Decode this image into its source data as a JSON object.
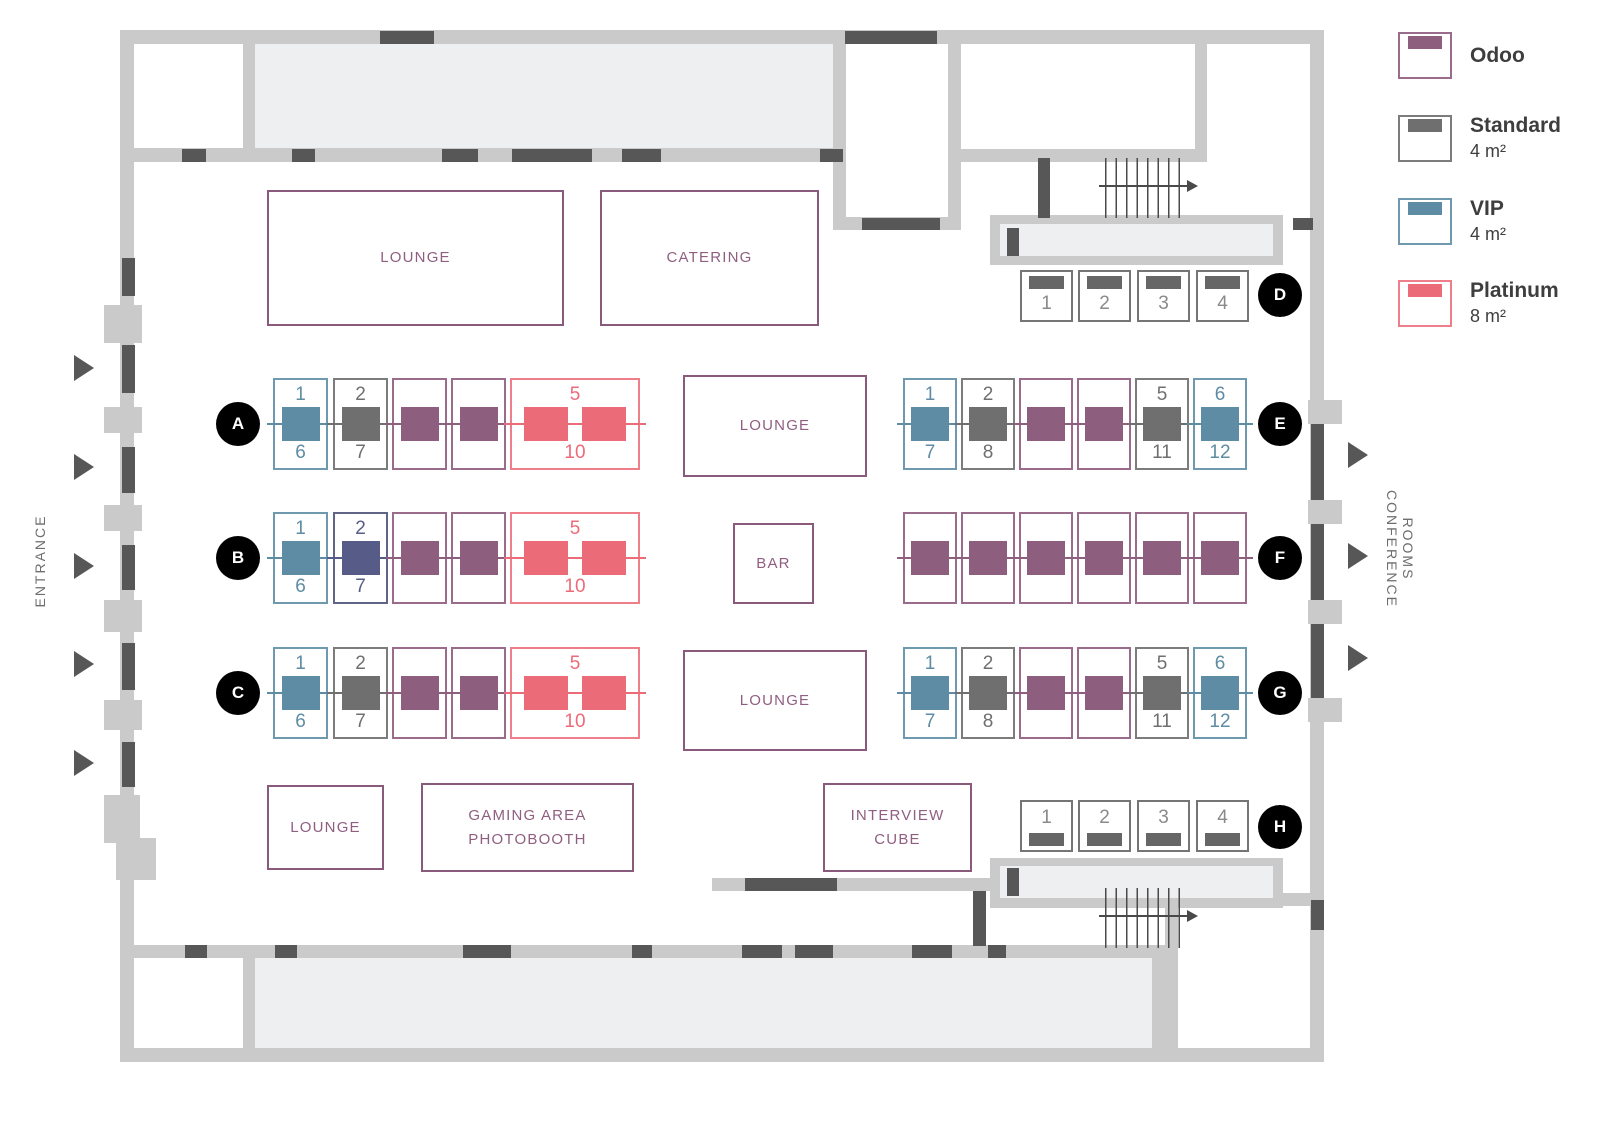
{
  "colors": {
    "odoo": "#8e5e7f",
    "odoo_border": "#9a6b8b",
    "standard": "#6f6f6f",
    "standard_border": "#7c7c7c",
    "vip": "#5e8ca4",
    "vip_border": "#6e99ae",
    "platinum": "#ec6b79",
    "platinum_border": "#ee7e8a",
    "reserved": "#575b87",
    "reserved_border": "#606489",
    "wall": "#cacaca",
    "room": "#edeff0",
    "door": "#575757",
    "label": "#8f5e81",
    "circle": "#000000"
  },
  "legend": {
    "items": [
      {
        "type": "odoo",
        "label": "Odoo",
        "size": ""
      },
      {
        "type": "standard",
        "label": "Standard",
        "size": "4 m²"
      },
      {
        "type": "vip",
        "label": "VIP",
        "size": "4 m²"
      },
      {
        "type": "platinum",
        "label": "Platinum",
        "size": "8 m²"
      }
    ]
  },
  "signs": {
    "entrance": "ENTRANCE",
    "conference_line1": "CONFERENCE",
    "conference_line2": "ROOMS"
  },
  "areas": {
    "lounge_top": "LOUNGE",
    "catering": "CATERING",
    "lounge_center_upper": "LOUNGE",
    "bar": "BAR",
    "lounge_center_lower": "LOUNGE",
    "lounge_bottom": "LOUNGE",
    "gaming_line1": "GAMING AREA",
    "gaming_line2": "PHOTOBOOTH",
    "interview_line1": "INTERVIEW",
    "interview_line2": "CUBE"
  },
  "rows": [
    {
      "letter": "A",
      "kind": "double",
      "booths": [
        {
          "type": "vip",
          "top": "1",
          "bottom": "6"
        },
        {
          "type": "standard",
          "top": "2",
          "bottom": "7"
        },
        {
          "type": "odoo"
        },
        {
          "type": "odoo"
        },
        {
          "type": "platinum",
          "top": "5",
          "bottom": "10"
        }
      ]
    },
    {
      "letter": "B",
      "kind": "double",
      "booths": [
        {
          "type": "vip",
          "top": "1",
          "bottom": "6"
        },
        {
          "type": "reserved",
          "top": "2",
          "bottom": "7"
        },
        {
          "type": "odoo"
        },
        {
          "type": "odoo"
        },
        {
          "type": "platinum",
          "top": "5",
          "bottom": "10"
        }
      ]
    },
    {
      "letter": "C",
      "kind": "double",
      "booths": [
        {
          "type": "vip",
          "top": "1",
          "bottom": "6"
        },
        {
          "type": "standard",
          "top": "2",
          "bottom": "7"
        },
        {
          "type": "odoo"
        },
        {
          "type": "odoo"
        },
        {
          "type": "platinum",
          "top": "5",
          "bottom": "10"
        }
      ]
    },
    {
      "letter": "D",
      "kind": "single-top",
      "booths": [
        {
          "type": "standard",
          "num": "1"
        },
        {
          "type": "standard",
          "num": "2"
        },
        {
          "type": "standard",
          "num": "3"
        },
        {
          "type": "standard",
          "num": "4"
        }
      ]
    },
    {
      "letter": "E",
      "kind": "double",
      "booths": [
        {
          "type": "vip",
          "top": "1",
          "bottom": "7"
        },
        {
          "type": "standard",
          "top": "2",
          "bottom": "8"
        },
        {
          "type": "odoo"
        },
        {
          "type": "odoo"
        },
        {
          "type": "standard",
          "top": "5",
          "bottom": "11"
        },
        {
          "type": "vip",
          "top": "6",
          "bottom": "12"
        }
      ]
    },
    {
      "letter": "F",
      "kind": "double",
      "booths": [
        {
          "type": "odoo"
        },
        {
          "type": "odoo"
        },
        {
          "type": "odoo"
        },
        {
          "type": "odoo"
        },
        {
          "type": "odoo"
        },
        {
          "type": "odoo"
        }
      ]
    },
    {
      "letter": "G",
      "kind": "double",
      "booths": [
        {
          "type": "vip",
          "top": "1",
          "bottom": "7"
        },
        {
          "type": "standard",
          "top": "2",
          "bottom": "8"
        },
        {
          "type": "odoo"
        },
        {
          "type": "odoo"
        },
        {
          "type": "standard",
          "top": "5",
          "bottom": "11"
        },
        {
          "type": "vip",
          "top": "6",
          "bottom": "12"
        }
      ]
    },
    {
      "letter": "H",
      "kind": "single-bottom",
      "booths": [
        {
          "type": "standard",
          "num": "1"
        },
        {
          "type": "standard",
          "num": "2"
        },
        {
          "type": "standard",
          "num": "3"
        },
        {
          "type": "standard",
          "num": "4"
        }
      ]
    }
  ]
}
